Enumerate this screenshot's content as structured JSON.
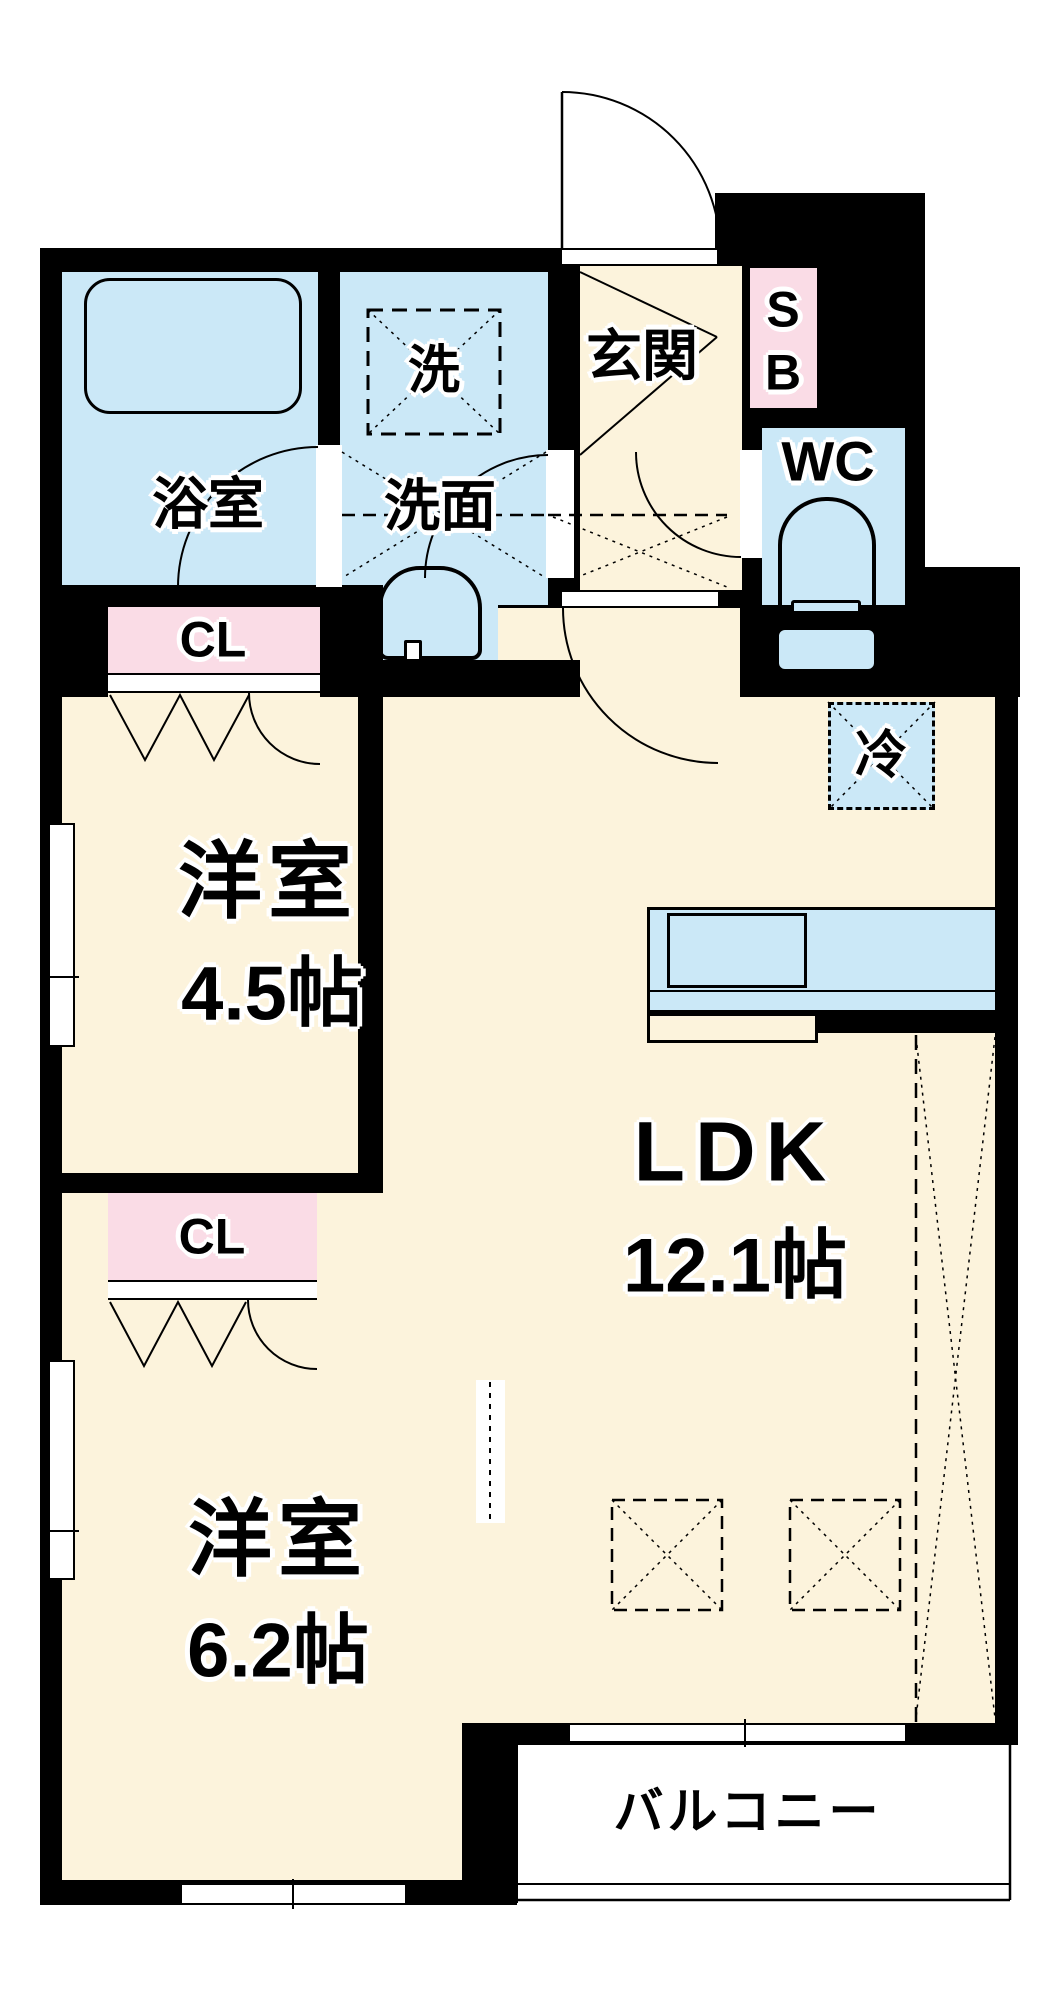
{
  "title": "apartment-floorplan",
  "labels": {
    "bathroom": "浴室",
    "laundry": "洗",
    "washroom": "洗面",
    "entrance": "玄関",
    "shoe_box": "S\nB",
    "toilet": "WC",
    "fridge": "冷",
    "closet_upper": "CL",
    "closet_lower": "CL",
    "room_upper_name": "洋室",
    "room_upper_size": "4.5帖",
    "ldk_name": "LDK",
    "ldk_size": "12.1帖",
    "room_lower_name": "洋室",
    "room_lower_size": "6.2帖",
    "balcony": "バルコニー"
  },
  "colors": {
    "floor": "#FCF3DC",
    "wet": "#CBE8F7",
    "closet": "#FADCE6",
    "wall": "#000000"
  }
}
